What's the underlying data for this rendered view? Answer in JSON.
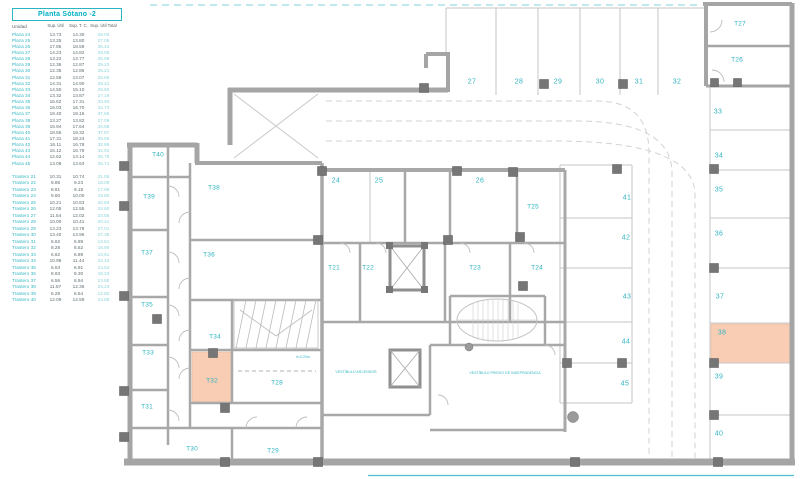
{
  "table": {
    "title": "Planta Sótano -2",
    "columns": [
      "Unidad",
      "Sup. Útil",
      "Sup. T. C.",
      "Sup. Útil Total"
    ],
    "plazas": [
      {
        "u": "Plaza 24",
        "s1": "13.73",
        "s2": "14.30",
        "t": "28.03"
      },
      {
        "u": "Plaza 25",
        "s1": "13.25",
        "s2": "13.80",
        "t": "27.05"
      },
      {
        "u": "Plaza 26",
        "s1": "17.85",
        "s2": "18.59",
        "t": "36.44"
      },
      {
        "u": "Plaza 27",
        "s1": "14.23",
        "s2": "14.82",
        "t": "29.05"
      },
      {
        "u": "Plaza 28",
        "s1": "13.22",
        "s2": "13.77",
        "t": "26.99"
      },
      {
        "u": "Plaza 29",
        "s1": "12.36",
        "s2": "12.87",
        "t": "25.23"
      },
      {
        "u": "Plaza 30",
        "s1": "12.35",
        "s2": "12.86",
        "t": "25.21"
      },
      {
        "u": "Plaza 31",
        "s1": "12.58",
        "s2": "13.07",
        "t": "25.65"
      },
      {
        "u": "Plaza 32",
        "s1": "14.31",
        "s2": "14.90",
        "t": "29.21"
      },
      {
        "u": "Plaza 33",
        "s1": "14.50",
        "s2": "15.10",
        "t": "29.60"
      },
      {
        "u": "Plaza 34",
        "s1": "13.32",
        "s2": "13.87",
        "t": "27.19"
      },
      {
        "u": "Plaza 35",
        "s1": "16.62",
        "s2": "17.31",
        "t": "33.93"
      },
      {
        "u": "Plaza 36",
        "s1": "16.03",
        "s2": "16.70",
        "t": "32.73"
      },
      {
        "u": "Plaza 37",
        "s1": "18.40",
        "s2": "19.16",
        "t": "37.56"
      },
      {
        "u": "Plaza 38",
        "s1": "13.27",
        "s2": "13.82",
        "t": "27.09"
      },
      {
        "u": "Plaza 39",
        "s1": "16.94",
        "s2": "17.64",
        "t": "34.58"
      },
      {
        "u": "Plaza 40",
        "s1": "18.55",
        "s2": "19.32",
        "t": "37.87"
      },
      {
        "u": "Plaza 41",
        "s1": "17.31",
        "s2": "18.24",
        "t": "35.55"
      },
      {
        "u": "Plaza 42",
        "s1": "16.11",
        "s2": "16.78",
        "t": "32.89"
      },
      {
        "u": "Plaza 43",
        "s1": "16.12",
        "s2": "16.79",
        "t": "32.91"
      },
      {
        "u": "Plaza 44",
        "s1": "12.62",
        "s2": "13.14",
        "t": "25.76"
      },
      {
        "u": "Plaza 45",
        "s1": "13.08",
        "s2": "13.63",
        "t": "26.71"
      }
    ],
    "trasteros": [
      {
        "u": "Trastero 21",
        "s1": "10.31",
        "s2": "10.74",
        "t": "21.05"
      },
      {
        "u": "Trastero 22",
        "s1": "8.86",
        "s2": "9.23",
        "t": "18.09"
      },
      {
        "u": "Trastero 23",
        "s1": "8.81",
        "s2": "9.18",
        "t": "17.99"
      },
      {
        "u": "Trastero 24",
        "s1": "9.60",
        "s2": "10.00",
        "t": "19.60"
      },
      {
        "u": "Trastero 25",
        "s1": "10.21",
        "s2": "10.63",
        "t": "20.84"
      },
      {
        "u": "Trastero 26",
        "s1": "12.05",
        "s2": "12.55",
        "t": "24.60"
      },
      {
        "u": "Trastero 27",
        "s1": "11.54",
        "s2": "12.02",
        "t": "23.56"
      },
      {
        "u": "Trastero 28",
        "s1": "10.00",
        "s2": "10.41",
        "t": "20.41"
      },
      {
        "u": "Trastero 29",
        "s1": "13.23",
        "s2": "13.78",
        "t": "27.01"
      },
      {
        "u": "Trastero 30",
        "s1": "13.40",
        "s2": "13.96",
        "t": "27.36"
      },
      {
        "u": "Trastero 31",
        "s1": "6.62",
        "s2": "6.89",
        "t": "13.51"
      },
      {
        "u": "Trastero 32",
        "s1": "8.28",
        "s2": "8.62",
        "t": "16.90"
      },
      {
        "u": "Trastero 33",
        "s1": "6.62",
        "s2": "6.89",
        "t": "13.51"
      },
      {
        "u": "Trastero 34",
        "s1": "10.98",
        "s2": "11.44",
        "t": "22.42"
      },
      {
        "u": "Trastero 35",
        "s1": "6.63",
        "s2": "6.91",
        "t": "13.54"
      },
      {
        "u": "Trastero 36",
        "s1": "8.93",
        "s2": "9.30",
        "t": "18.23"
      },
      {
        "u": "Trastero 37",
        "s1": "6.56",
        "s2": "6.94",
        "t": "13.50"
      },
      {
        "u": "Trastero 38",
        "s1": "11.87",
        "s2": "12.36",
        "t": "24.23"
      },
      {
        "u": "Trastero 39",
        "s1": "6.28",
        "s2": "6.54",
        "t": "12.82"
      },
      {
        "u": "Trastero 40",
        "s1": "12.09",
        "s2": "12.59",
        "t": "24.68"
      }
    ]
  },
  "plan": {
    "accent_color": "#2fb4c1",
    "wall_color": "#a5a5a5",
    "highlight_color": "#f8cdb4",
    "highlighted_units": [
      "T32",
      "38"
    ],
    "parking_labels": [
      {
        "label": "24",
        "x": 336,
        "y": 181
      },
      {
        "label": "25",
        "x": 379,
        "y": 181
      },
      {
        "label": "26",
        "x": 480,
        "y": 181
      },
      {
        "label": "27",
        "x": 472,
        "y": 82
      },
      {
        "label": "28",
        "x": 519,
        "y": 82
      },
      {
        "label": "29",
        "x": 558,
        "y": 82
      },
      {
        "label": "30",
        "x": 600,
        "y": 82
      },
      {
        "label": "31",
        "x": 639,
        "y": 82
      },
      {
        "label": "32",
        "x": 677,
        "y": 82
      },
      {
        "label": "33",
        "x": 718,
        "y": 112
      },
      {
        "label": "34",
        "x": 719,
        "y": 156
      },
      {
        "label": "35",
        "x": 719,
        "y": 190
      },
      {
        "label": "36",
        "x": 719,
        "y": 234
      },
      {
        "label": "37",
        "x": 720,
        "y": 297
      },
      {
        "label": "38",
        "x": 722,
        "y": 333
      },
      {
        "label": "39",
        "x": 719,
        "y": 377
      },
      {
        "label": "40",
        "x": 719,
        "y": 434
      },
      {
        "label": "41",
        "x": 627,
        "y": 198
      },
      {
        "label": "42",
        "x": 626,
        "y": 238
      },
      {
        "label": "43",
        "x": 627,
        "y": 297
      },
      {
        "label": "44",
        "x": 626,
        "y": 342
      },
      {
        "label": "45",
        "x": 625,
        "y": 384
      }
    ],
    "room_labels": [
      {
        "label": "T21",
        "x": 334,
        "y": 268
      },
      {
        "label": "T22",
        "x": 368,
        "y": 268
      },
      {
        "label": "T23",
        "x": 475,
        "y": 268
      },
      {
        "label": "T24",
        "x": 537,
        "y": 268
      },
      {
        "label": "T25",
        "x": 533,
        "y": 207
      },
      {
        "label": "T26",
        "x": 737,
        "y": 60
      },
      {
        "label": "T27",
        "x": 740,
        "y": 24
      },
      {
        "label": "T28",
        "x": 277,
        "y": 383
      },
      {
        "label": "T29",
        "x": 273,
        "y": 451
      },
      {
        "label": "T30",
        "x": 192,
        "y": 449
      },
      {
        "label": "T31",
        "x": 147,
        "y": 407
      },
      {
        "label": "T32",
        "x": 212,
        "y": 381
      },
      {
        "label": "T33",
        "x": 148,
        "y": 353
      },
      {
        "label": "T34",
        "x": 215,
        "y": 337
      },
      {
        "label": "T35",
        "x": 147,
        "y": 305
      },
      {
        "label": "T36",
        "x": 209,
        "y": 255
      },
      {
        "label": "T37",
        "x": 147,
        "y": 253
      },
      {
        "label": "T38",
        "x": 214,
        "y": 188
      },
      {
        "label": "T39",
        "x": 149,
        "y": 197
      },
      {
        "label": "T40",
        "x": 158,
        "y": 155
      }
    ],
    "annotations": [
      {
        "label": "h<2.20m",
        "x": 303,
        "y": 357
      },
      {
        "label": "VESTÍBULO ASCENSOR",
        "x": 356,
        "y": 372
      },
      {
        "label": "VESTÍBULO PREVIO DE INDEPENDENCIA",
        "x": 505,
        "y": 373
      }
    ]
  }
}
